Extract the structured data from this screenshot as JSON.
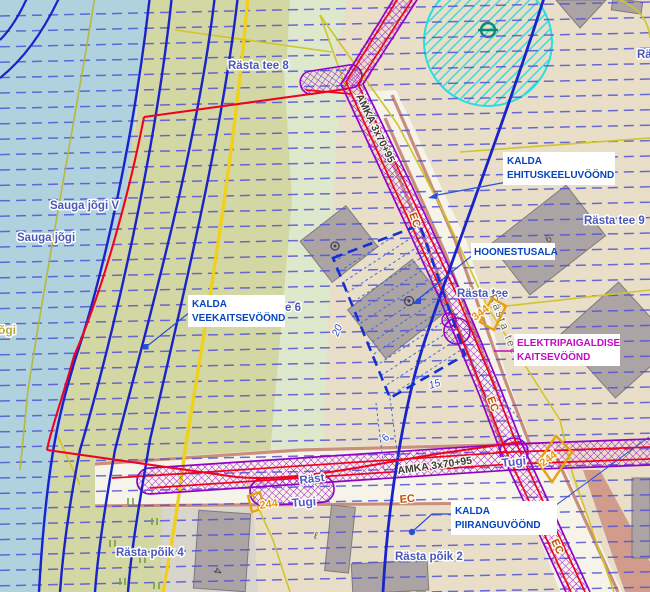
{
  "labels": {
    "rasta_tee_8": "Rästa tee 8",
    "rasta_tee_9": "Rästa tee 9",
    "rasta_partial_right": "Rä",
    "sauga_jogi_v": "Sauga jõgi V",
    "sauga_jogi": "Sauga jõgi",
    "jogi_partial": "õgi",
    "rasta_tee_6_partial": "e 6",
    "rasta_tee": "Rästa tee",
    "rasta_tee_road": "Rästa tee",
    "rasta_tee_bottom_partial": "Räst",
    "rasta_poik_4": "Rästa põik 4",
    "rasta_poik_2": "Rästa põik 2"
  },
  "callouts": {
    "ehituskeeluvoond": {
      "line1": "KALDA",
      "line2": "EHITUSKEELUVÖÖND"
    },
    "hoonestusala": {
      "line1": "HOONESTUSALA"
    },
    "veekaitsevoond": {
      "line1": "KALDA",
      "line2": "VEEKAITSEVÖÖND"
    },
    "elektripaigaldise": {
      "line1": "ELEKTRIPAIGALDISE",
      "line2": "KAITSEVÖÖND"
    },
    "piiranguvoond": {
      "line1": "KALDA",
      "line2": "PIIRANGUVÖÖND"
    }
  },
  "cable": {
    "amka": "AMKA 3x70+95",
    "ec": "EC"
  },
  "markers": {
    "tugi": "Tugi",
    "n244": "244",
    "n344": "344"
  },
  "dims": {
    "d20": "20",
    "d15": "15",
    "d6": "6",
    "d9": "9",
    "d4": "4",
    "dl": "ℓ"
  },
  "colors": {
    "water": "#afd2de",
    "parcel_olive": "#d3d7a3",
    "beige": "#e9dfc8",
    "pale_green": "#dde8cc",
    "road_white": "#f6f3e8",
    "road_salmon": "#c98f7c",
    "building_gray": "#aba3a4",
    "contour_dash_blue": "#5353d6",
    "line_blue": "#1a23c8",
    "road_yellow": "#f0d01e",
    "cadastral_yellow": "#cfc52c",
    "boundary_red": "#ee0322",
    "corridor_purple": "#9203c8",
    "label_magenta": "#c40bc4",
    "radius_cyan": "#2adbe2",
    "callout_blue": "#0546bd",
    "street_blue": "#4a58b8",
    "ec_orange": "#c05010",
    "marker_orange": "#e8950f"
  }
}
